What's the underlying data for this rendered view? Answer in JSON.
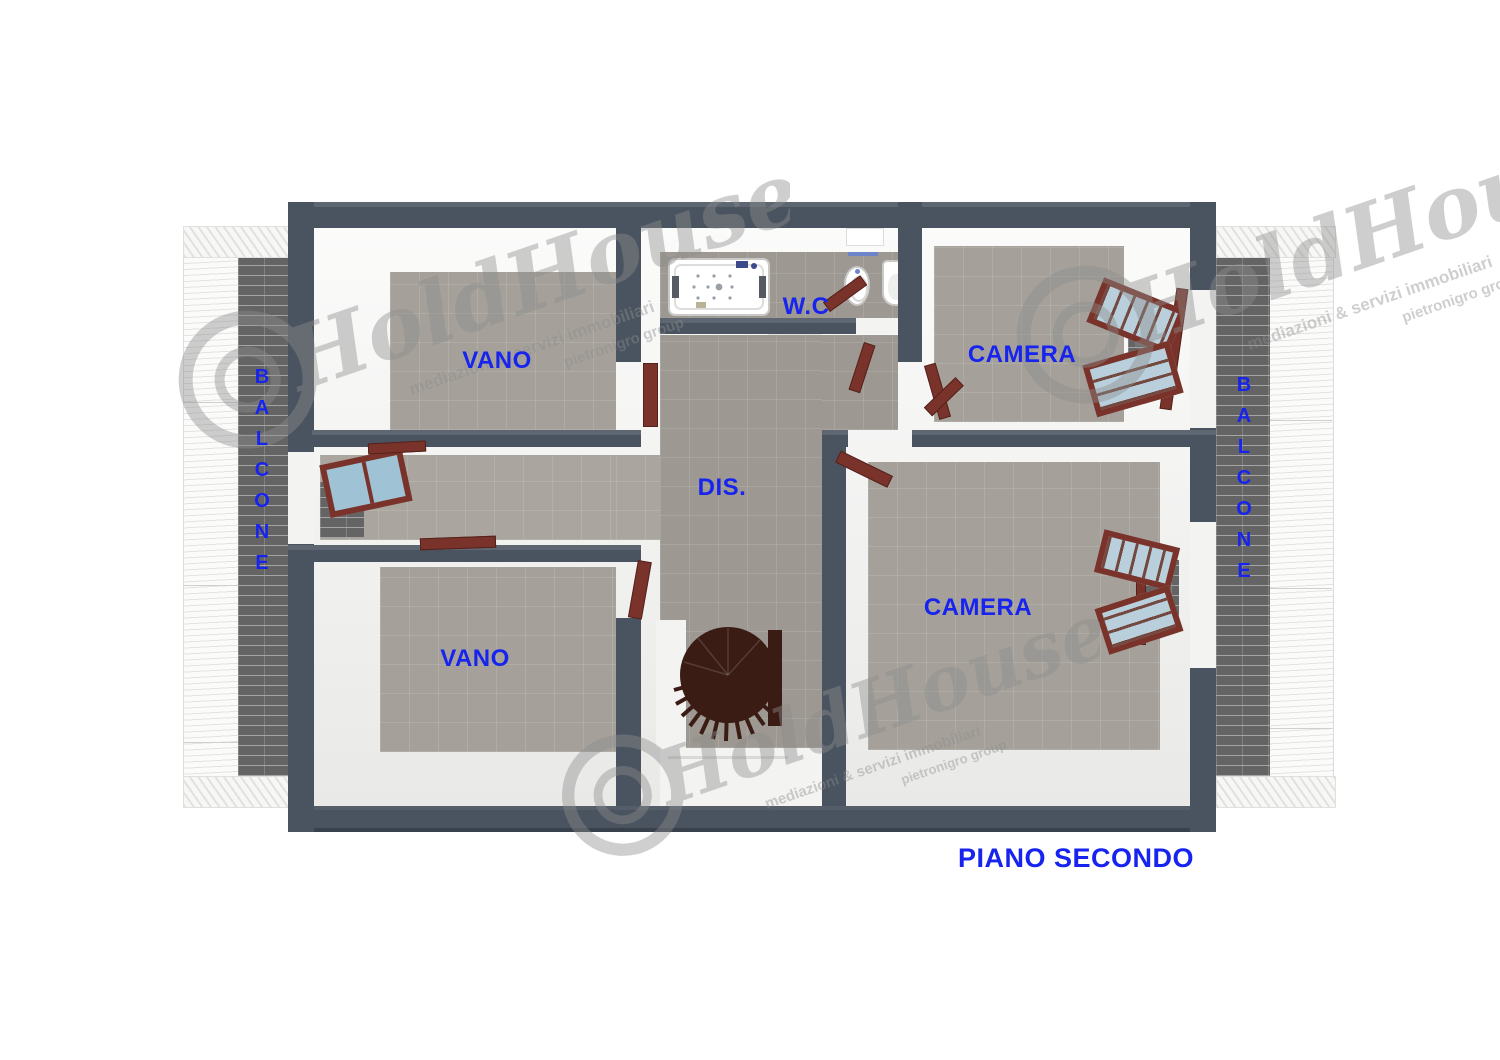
{
  "title": "PIANO SECONDO",
  "labels": {
    "vano_top": "VANO",
    "wc": "W.C",
    "camera_top": "CAMERA",
    "dis": "DIS.",
    "vano_bottom": "VANO",
    "camera_bottom": "CAMERA"
  },
  "balcony": {
    "label": "BALCONE",
    "letters": [
      "B",
      "A",
      "L",
      "C",
      "O",
      "N",
      "E"
    ]
  },
  "watermark": {
    "brand": "HoldHouse",
    "tagline": "mediazioni & servizi immobiliari",
    "subline": "pietronigro group"
  },
  "colors": {
    "wall": "#4a5460",
    "floor": "#a5a19a",
    "label_blue": "#1723ee",
    "door_wood": "#7a332a",
    "stair_wood": "#3a1c14",
    "brick": "#646464"
  }
}
